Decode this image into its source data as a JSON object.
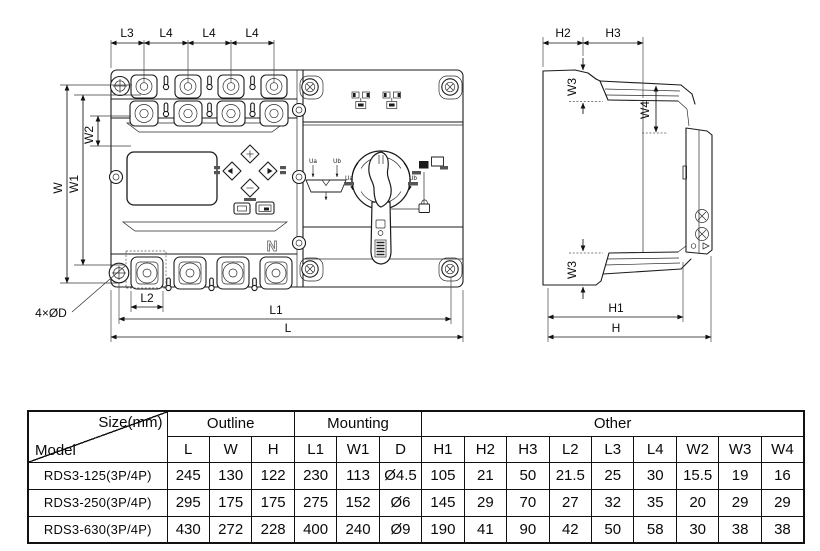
{
  "colors": {
    "ink": "#1b1b1b",
    "paper": "#ffffff"
  },
  "labels": {
    "front": {
      "l3": "L3",
      "l4": "L4",
      "w": "W",
      "w1": "W1",
      "w2": "W2",
      "l2": "L2",
      "l1": "L1",
      "l": "L",
      "holes": "4×ØD",
      "n": "N",
      "ua": "Ua",
      "ub": "Ub"
    },
    "side": {
      "h2": "H2",
      "h3": "H3",
      "w3": "W3",
      "w4": "W4",
      "h1": "H1",
      "h": "H"
    }
  },
  "table": {
    "size_label": "Size(mm)",
    "model_label": "Model",
    "groups": [
      {
        "label": "Outline"
      },
      {
        "label": "Mounting"
      },
      {
        "label": "Other"
      }
    ],
    "columns": [
      "L",
      "W",
      "H",
      "L1",
      "W1",
      "D",
      "H1",
      "H2",
      "H3",
      "L2",
      "L3",
      "L4",
      "W2",
      "W3",
      "W4"
    ],
    "rows": [
      {
        "model": "RDS3-125(3P/4P)",
        "values": [
          "245",
          "130",
          "122",
          "230",
          "113",
          "Ø4.5",
          "105",
          "21",
          "50",
          "21.5",
          "25",
          "30",
          "15.5",
          "19",
          "16"
        ]
      },
      {
        "model": "RDS3-250(3P/4P)",
        "values": [
          "295",
          "175",
          "175",
          "275",
          "152",
          "Ø6",
          "145",
          "29",
          "70",
          "27",
          "32",
          "35",
          "20",
          "29",
          "29"
        ]
      },
      {
        "model": "RDS3-630(3P/4P)",
        "values": [
          "430",
          "272",
          "228",
          "400",
          "240",
          "Ø9",
          "190",
          "41",
          "90",
          "42",
          "50",
          "58",
          "30",
          "38",
          "38"
        ]
      }
    ]
  }
}
